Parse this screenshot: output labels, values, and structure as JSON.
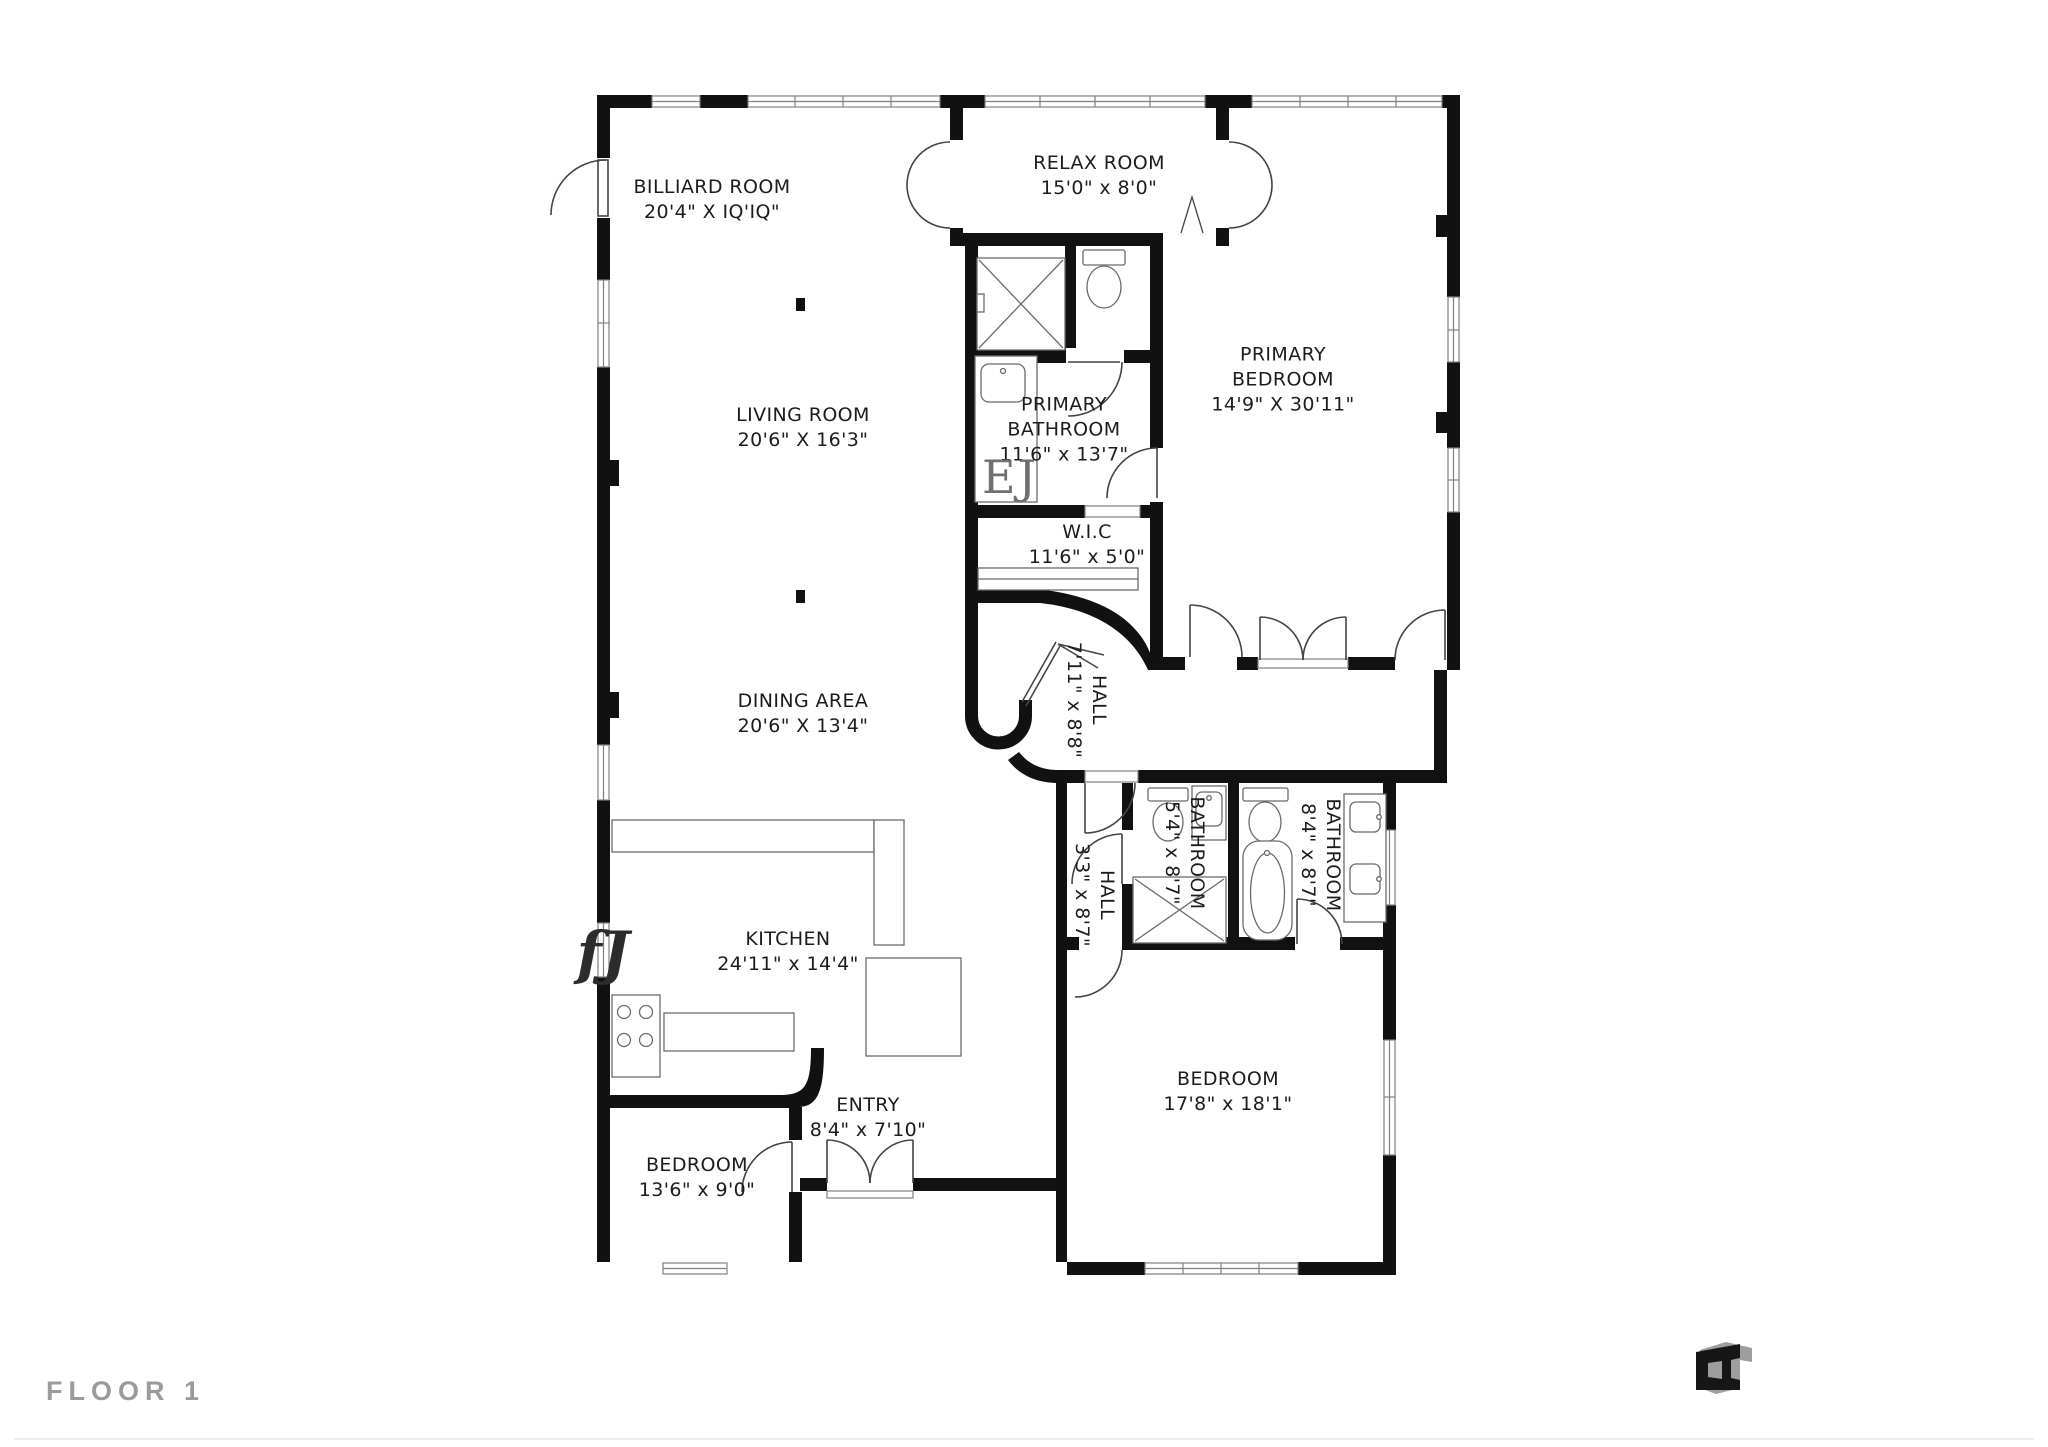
{
  "page": {
    "background": "#ffffff",
    "floor_label": "FLOOR 1",
    "floor_label_color": "#9b9b9b"
  },
  "plan": {
    "wall_color": "#111111",
    "fixture_line_color": "#6b6b6b",
    "door_line_color": "#444444",
    "window_line_color": "#808080",
    "label_color": "#1c1c1c",
    "rooms": [
      {
        "id": "billiard-room",
        "lines": [
          "BILLIARD ROOM",
          "20'4\" X IQ'IQ\""
        ],
        "x": 712,
        "y": 200,
        "rot": 0
      },
      {
        "id": "relax-room",
        "lines": [
          "RELAX ROOM",
          "15'0\" x 8'0\""
        ],
        "x": 1099,
        "y": 176,
        "rot": 0
      },
      {
        "id": "primary-bedroom",
        "lines": [
          "PRIMARY",
          "BEDROOM",
          "14'9\" X 30'11\""
        ],
        "x": 1283,
        "y": 380,
        "rot": 0
      },
      {
        "id": "living-room",
        "lines": [
          "LIVING ROOM",
          "20'6\" X 16'3\""
        ],
        "x": 803,
        "y": 428,
        "rot": 0
      },
      {
        "id": "primary-bathroom",
        "lines": [
          "PRIMARY",
          "BATHROOM",
          "11'6\" x 13'7\""
        ],
        "x": 1064,
        "y": 430,
        "rot": 0
      },
      {
        "id": "wic",
        "lines": [
          "W.I.C",
          "11'6\" x 5'0\""
        ],
        "x": 1087,
        "y": 545,
        "rot": 0
      },
      {
        "id": "hall-upper",
        "lines": [
          "HALL",
          "7'11\" x 8'8\""
        ],
        "x": 1086,
        "y": 700,
        "rot": 90
      },
      {
        "id": "dining-area",
        "lines": [
          "DINING AREA",
          "20'6\" X 13'4\""
        ],
        "x": 803,
        "y": 714,
        "rot": 0
      },
      {
        "id": "kitchen",
        "lines": [
          "KITCHEN",
          "24'11\" x 14'4\""
        ],
        "x": 788,
        "y": 952,
        "rot": 0
      },
      {
        "id": "hall-lower",
        "lines": [
          "HALL",
          "3'3\" x 8'7\""
        ],
        "x": 1094,
        "y": 895,
        "rot": 90
      },
      {
        "id": "bathroom-small",
        "lines": [
          "BATHROOM",
          "5'4\" x 8'7\""
        ],
        "x": 1184,
        "y": 853,
        "rot": 90
      },
      {
        "id": "bathroom-large",
        "lines": [
          "BATHROOM",
          "8'4\" x 8'7\""
        ],
        "x": 1320,
        "y": 855,
        "rot": 90
      },
      {
        "id": "bedroom-right",
        "lines": [
          "BEDROOM",
          "17'8\" x 18'1\""
        ],
        "x": 1228,
        "y": 1092,
        "rot": 0
      },
      {
        "id": "entry",
        "lines": [
          "ENTRY",
          "8'4\" x 7'10\""
        ],
        "x": 868,
        "y": 1118,
        "rot": 0
      },
      {
        "id": "bedroom-left",
        "lines": [
          "BEDROOM",
          "13'6\" x 9'0\""
        ],
        "x": 697,
        "y": 1178,
        "rot": 0
      }
    ],
    "artifacts": [
      {
        "id": "ej",
        "text": "EJ",
        "x": 1010,
        "y": 477
      },
      {
        "id": "fj",
        "text": "fJ",
        "x": 603,
        "y": 953
      }
    ]
  },
  "logo": {
    "name": "floorplan-brand-mark",
    "dark": "#161616",
    "mid": "#9e9e9e"
  }
}
